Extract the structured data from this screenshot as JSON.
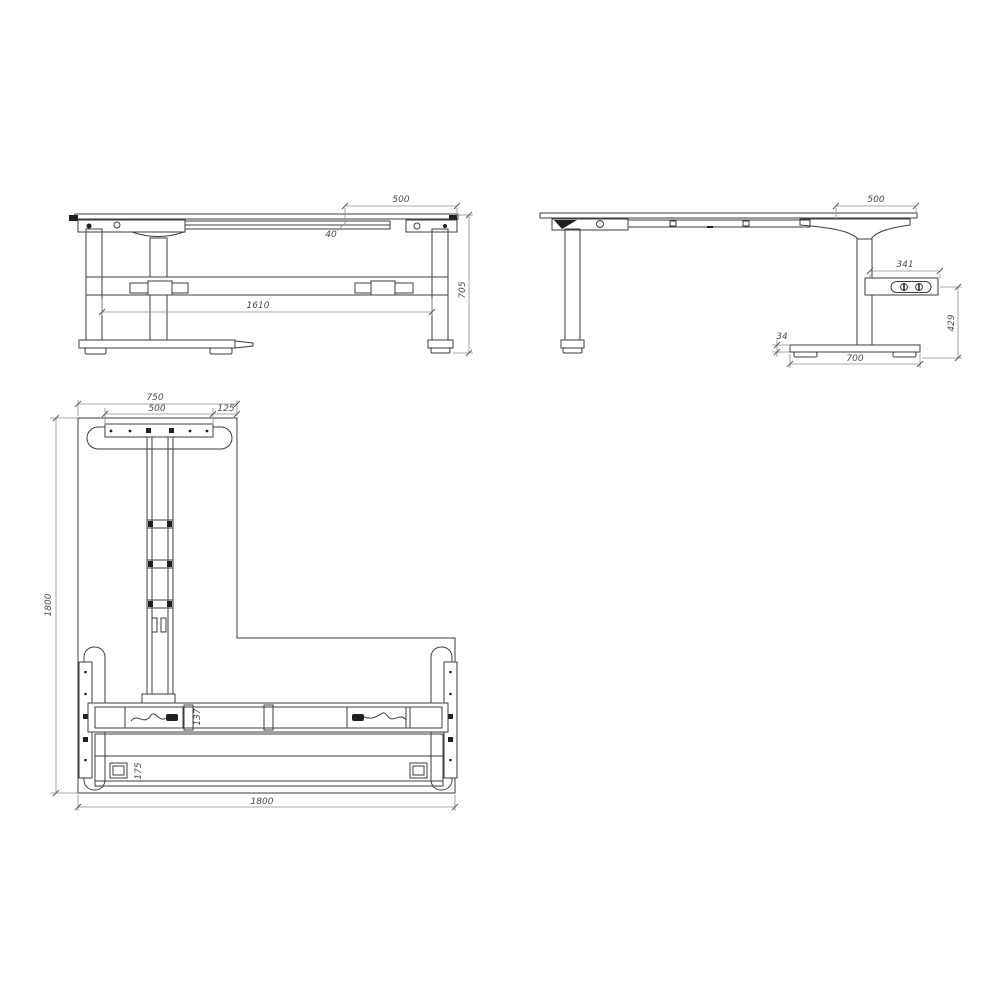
{
  "document": {
    "type": "technical-drawing",
    "subject": "L-shaped height-adjustable desk frame, three orthographic views",
    "colors": {
      "background": "#ffffff",
      "geometry_line": "#3d3d3d",
      "dimension_line": "#8c8c8c",
      "dimension_text": "#4a4a4a",
      "solid_fill": "#1f1f1f"
    }
  },
  "views": {
    "front": {
      "dims": {
        "overhang": "500",
        "frame": "40",
        "span": "1610",
        "height": "705"
      }
    },
    "side": {
      "dims": {
        "overhang": "500",
        "box_width": "341",
        "box_floor": "429",
        "foot_h": "34",
        "foot_len": "700"
      }
    },
    "plan": {
      "dims": {
        "arm_width": "750",
        "bracket": "500",
        "offset": "125",
        "depth": "1800",
        "width": "1800",
        "beam": "137",
        "rail": "175"
      }
    }
  },
  "icons": {
    "control": "updown-control-icon",
    "cable_left": "power-plug-icon",
    "cable_right": "power-plug-icon",
    "screws": "screw-dot-icon"
  }
}
